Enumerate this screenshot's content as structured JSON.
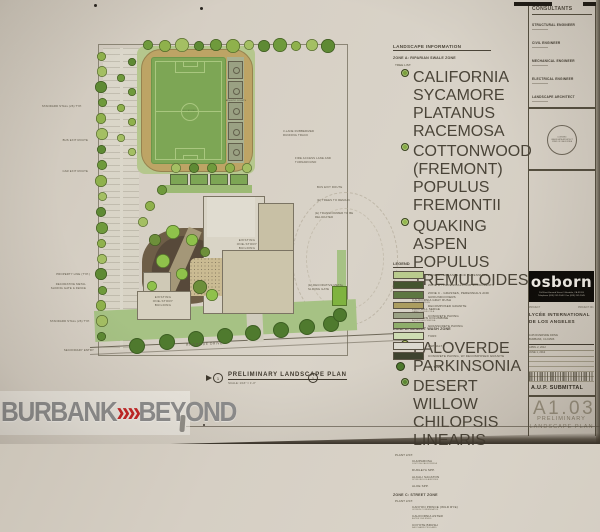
{
  "watermark": {
    "left": "BURBANK",
    "chevron": "»",
    "right": "BEYOND"
  },
  "titleblock": {
    "consultants_label": "CONSULTANTS",
    "consultants": [
      {
        "role": "STRUCTURAL ENGINEER"
      },
      {
        "role": "CIVIL ENGINEER"
      },
      {
        "role": "MECHANICAL ENGINEER"
      },
      {
        "role": "ELECTRICAL ENGINEER"
      },
      {
        "role": "LANDSCAPE ARCHITECT"
      }
    ],
    "stamp": {
      "line1": "LICENSED",
      "line2": "LANDSCAPE ARCHITECT",
      "line3": "STATE OF CALIFORNIA"
    },
    "firm": {
      "name": "osborn",
      "address_line1": "104 East Harvard Street / Glendale, CA 91205",
      "address_line2": "Telephone (818) 242-2040 / Fax (818) 242-2045"
    },
    "project_label": "PROJECT",
    "project_no_label": "PROJECT NO.",
    "project_name_line1": "LYCÉE INTERNATIONAL",
    "project_name_line2": "DE LOS ANGELES",
    "site_address_line1": "1105 RIVERSIDE DRIVE",
    "site_address_line2": "BURBANK, CA 91506",
    "revisions": [
      {
        "label": "APRIL 2, 2012"
      },
      {
        "label": "JUNE 1, 2012"
      }
    ],
    "submittal": "A.U.P. SUBMITTAL",
    "sheet_number": "A1.03",
    "sheet_title_line1": "PRELIMINARY",
    "sheet_title_line2": "LANDSCAPE PLAN"
  },
  "landscape_info": {
    "heading": "LANDSCAPE INFORMATION",
    "zones": [
      {
        "title": "ZONE A: RIPARIAN SWALE ZONE",
        "sections": [
          {
            "label": "TREE LIST:",
            "type": "tree",
            "items": [
              {
                "name": "CALIFORNIA SYCAMORE",
                "latin": "PLATANUS RACEMOSA",
                "icon_color": "#7aa03c"
              },
              {
                "name": "COTTONWOOD (FREMONT)",
                "latin": "POPULUS FREMONTII",
                "icon_color": "#86ab45"
              },
              {
                "name": "QUAKING ASPEN",
                "latin": "POPULUS TREMULOIDES",
                "icon_color": "#93b84e"
              }
            ]
          },
          {
            "label": "PLANT LIST:",
            "type": "plant",
            "items": [
              {
                "name": "CALIFORNIA GRAY RUSH",
                "latin": "JUNCUS PATENS"
              },
              {
                "name": "FOOTHILL SEDGE",
                "latin": "CAREX TUMULICOLA"
              },
              {
                "name": "WESTERN COLUMBINE",
                "latin": "AQUILEGIA FORMOSA"
              }
            ]
          }
        ]
      },
      {
        "title": "ZONE B: DESERT WASH ZONE",
        "sections": [
          {
            "label": "TREE LIST:",
            "type": "tree",
            "items": [
              {
                "name": "PALOVERDE",
                "latin": "PARKINSONIA",
                "icon_color": "#a9b83e"
              },
              {
                "name": "DESERT WILLOW",
                "latin": "CHILOPSIS LINEARIS",
                "icon_color": "#5d8a33"
              }
            ]
          },
          {
            "label": "PLANT LIST:",
            "type": "plant",
            "items": [
              {
                "name": "CHUPAROSA",
                "latin": "JUSTICIA CALIFORNICA"
              },
              {
                "name": "DUDLEYA SPP.",
                "latin": ""
              },
              {
                "name": "ALKALI SACATON",
                "latin": "SPOROBOLUS AIROIDES"
              },
              {
                "name": "ALOE SPP.",
                "latin": ""
              }
            ]
          }
        ]
      },
      {
        "title": "ZONE C: STREET ZONE",
        "sections": [
          {
            "label": "PLANT LIST:",
            "type": "plant",
            "items": [
              {
                "name": "CANYON PRINCE (WILD RYE)",
                "latin": "LEYMUS CONDENSATUS"
              },
              {
                "name": "CALIFORNIA ASTER",
                "latin": "ASTER CHILENSIS"
              },
              {
                "name": "COYOTE BRUSH",
                "latin": "BACCHARIS PILULARIS"
              }
            ]
          }
        ]
      }
    ]
  },
  "legend": {
    "heading": "LEGEND",
    "items": [
      {
        "label": "ZONE A - GRASSES AND PERENNIALS",
        "color": "#b9cb8d"
      },
      {
        "label": "ZONE B - PERENNIALS AND SUCCULENTS",
        "color": "#44552f"
      },
      {
        "label": "ZONE C - GRASSES, PERENNIALS AND GROUNDCOVERS",
        "color": "#5e7742"
      },
      {
        "label": "DECOMPOSED GRANITE",
        "color": "#ab9d60"
      },
      {
        "label": "CONCRETE PAVING",
        "color": "#9ba285"
      },
      {
        "label": "GRASSCRETE PAVING",
        "color": "#8fae6b"
      },
      {
        "label": "TURF",
        "color": "#cedcb2"
      },
      {
        "label": "ASPHALT",
        "color": "#dcd9cf"
      },
      {
        "label": "CONCRETE PAVING, W/ DECOMPOSED GRANITE",
        "color": "#3e432f"
      },
      {
        "label": "(E) TREE",
        "color": "#4e7a2e",
        "symbol": "tree"
      }
    ]
  },
  "plan": {
    "labels": {
      "soccer_field": "SOCCER FIELD",
      "athletic_courts": "ATHLETIC COURTS",
      "existing_building_main": "EXISTING ONE-STORY BUILDING",
      "existing_building_small": "EXISTING ONE-STORY BUILDING",
      "street": "RIVERSIDE DRIVE",
      "title": "PRELIMINARY LANDSCAPE PLAN",
      "scale": "SCALE: 1/16\" = 1'-0\"",
      "detail_number": "1"
    },
    "annotations_left": [
      {
        "text": "STANDARD STALL (26) TYP."
      },
      {
        "text": "BUS EXIT ROUTE"
      },
      {
        "text": "CAR EXIT ROUTE"
      },
      {
        "text": "PROPERTY LINE (TYP.)"
      },
      {
        "text": "DECORATIVE METAL SLIDING GATE & FENCE"
      },
      {
        "text": "STANDARD STALL (26) TYP."
      },
      {
        "text": "SECONDARY ENTRY"
      }
    ],
    "annotations_right": [
      {
        "text": "3-LANE RUBBERIZED RUNNING TRACK"
      },
      {
        "text": "FIRE ACCESS LANE AND TURNAROUND"
      },
      {
        "text": "BUS EXIT ROUTE"
      },
      {
        "text": "(E) TREES TO REMAIN"
      },
      {
        "text": "(E) TRANSFORMER TO BE RELOCATED"
      },
      {
        "text": "(E) DECORATIVE METAL SLIDING GATE"
      }
    ]
  }
}
